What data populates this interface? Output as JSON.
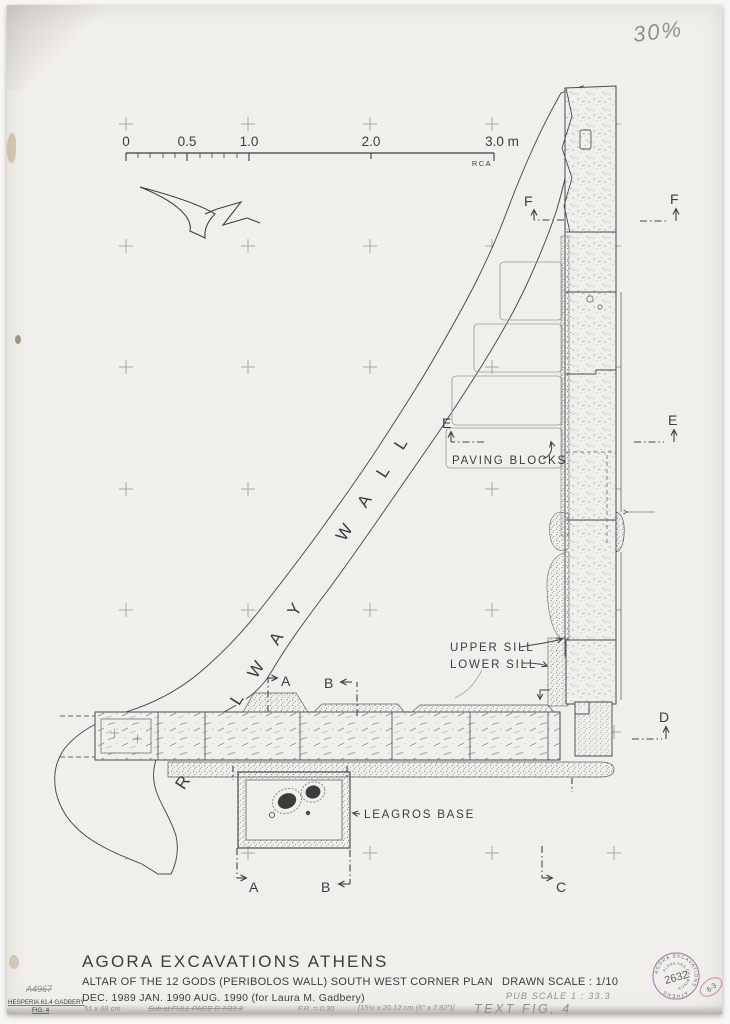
{
  "sheet": {
    "note30": "30%",
    "colors": {
      "paper": "#f1efeb",
      "ink": "#3d3d3d",
      "pencil": "#90908e",
      "stamp_purple": "#83759e",
      "stamp_red": "#c4756f"
    },
    "scale_bar": {
      "labels": [
        "0",
        "0.5",
        "1.0",
        "2.0",
        "3.0 m"
      ],
      "credit": "RCA"
    },
    "labels": {
      "railway_wall": "RAILWAY WALL",
      "paving_blocks": "PAVING BLOCKS",
      "upper_sill": "UPPER SILL",
      "lower_sill": "LOWER SILL",
      "leagros_base": "LEAGROS BASE"
    },
    "sections": {
      "a": "A",
      "b": "B",
      "c": "C",
      "d": "D",
      "e": "E",
      "f": "F"
    },
    "title_block": {
      "line1": "AGORA  EXCAVATIONS  ATHENS",
      "line2": "ALTAR OF THE 12 GODS (PERIBOLOS WALL)  SOUTH WEST CORNER  PLAN",
      "drawn_scale": "DRAWN SCALE : 1/10",
      "line3": "DEC. 1989  JAN. 1990  AUG. 1990     (for Laura  M. Gadbery)",
      "pub_scale": "PUB SCALE      1 : 33.3"
    },
    "pencil_notes": {
      "size": "51 x 68 cm",
      "struck": "Sub at  FULL PAGE   R 7/33.3",
      "fr": "F.R. = 0.30",
      "bracket": "[15¼ x 20.12 cm (6\" x 7.92\")]",
      "fig": "TEXT  FIG,  4"
    },
    "margin": {
      "negnum": "A4967",
      "ref1": "HESPERIA 61.4 GADBERY",
      "ref2": "FIG. 4"
    },
    "stamp": {
      "ring": "AGORA EXCAVATIONS · ATHENS ·",
      "inner": "PLANS AND DRAWINGS",
      "number": "2632",
      "red": "6-3"
    }
  }
}
